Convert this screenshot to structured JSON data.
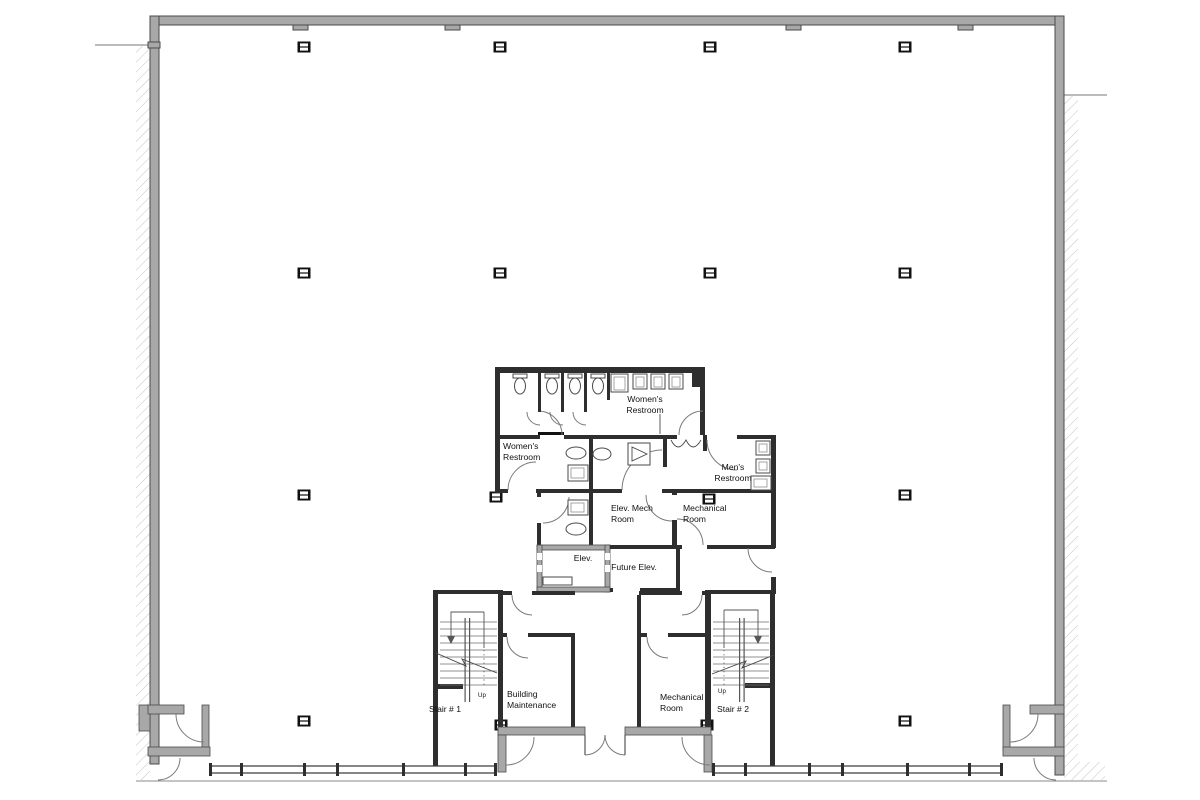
{
  "title": "Office building floor plan",
  "colors": {
    "wall_gray": "#a8a8a8",
    "ink": "#111111",
    "line": "#444444"
  },
  "rooms": {
    "womens_top": {
      "line1": "Women's",
      "line2": "Restroom"
    },
    "womens_left": {
      "line1": "Women's",
      "line2": "Restroom"
    },
    "mens": {
      "line1": "Men's",
      "line2": "Restroom"
    },
    "elev_mech": {
      "line1": "Elev. Mech",
      "line2": "Room"
    },
    "mechanical_upper": {
      "line1": "Mechanical",
      "line2": "Room"
    },
    "elevator": {
      "line1": "Elev."
    },
    "future_elevator": {
      "line1": "Future Elev."
    },
    "building_maintenance": {
      "line1": "Building",
      "line2": "Maintenance"
    },
    "mechanical_lower": {
      "line1": "Mechanical",
      "line2": "Room"
    },
    "stair_1": {
      "line1": "Stair # 1"
    },
    "stair_2": {
      "line1": "Stair # 2"
    }
  },
  "annotations": {
    "up": "Up"
  }
}
